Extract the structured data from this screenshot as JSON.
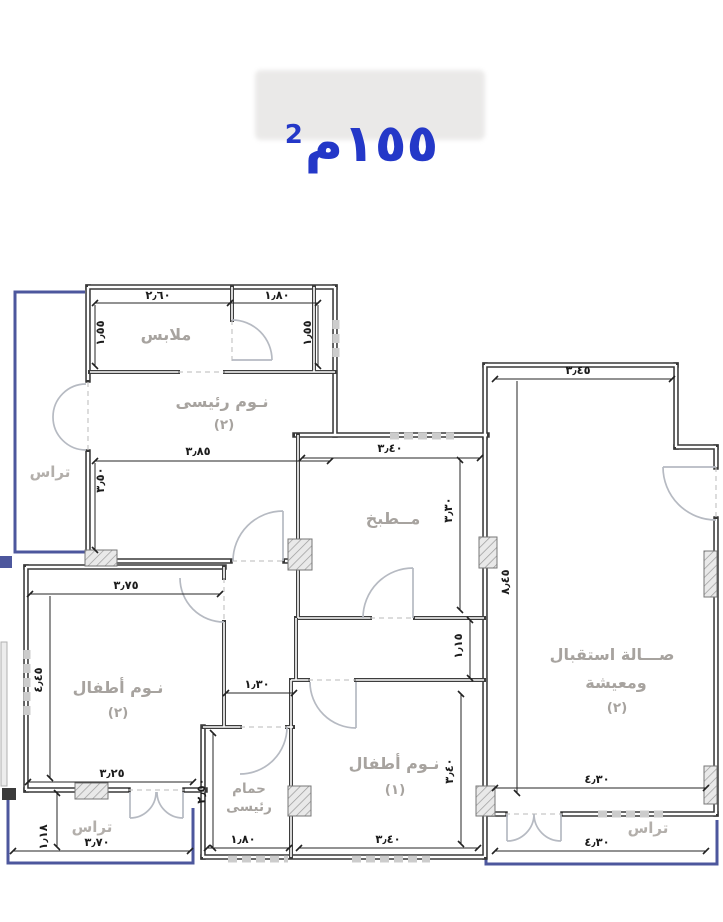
{
  "title": {
    "value": "١٥٥م",
    "sup": "2"
  },
  "colors": {
    "title_blue": "#2438c8",
    "terrace_outline": "#4d579d"
  },
  "rooms": {
    "closet": {
      "label": "ملابس"
    },
    "master_bedroom": {
      "line1": "نـوم رئيسى",
      "line2": "(٢)"
    },
    "terrace_left": {
      "label": "تراس"
    },
    "kitchen": {
      "label": "مــطبخ"
    },
    "reception": {
      "line1": "صـــالة استقبال",
      "line2": "ومعيشة",
      "line3": "(٢)"
    },
    "kids_bedroom_2": {
      "line1": "نـوم أطفال",
      "line2": "(٢)"
    },
    "master_bath": {
      "line1": "حمام",
      "line2": "رئيسى"
    },
    "kids_bedroom_1": {
      "line1": "نـوم أطفال",
      "line2": "(١)"
    },
    "terrace_bottom_left": {
      "label": "تراس"
    },
    "terrace_bottom_right": {
      "label": "تراس"
    }
  },
  "dimensions": {
    "closet_width": "٢٫٦٠",
    "dressing_width": "١٫٨٠",
    "closet_height": "١٫٥٥",
    "dressing_height": "١٫٥٥",
    "master_width": "٣٫٨٥",
    "master_height": "٣٫٥٠",
    "kitchen_width": "٣٫٤٠",
    "kitchen_height": "٣٫٣٠",
    "reception_width": "٣٫٤٥",
    "reception_height": "٨٫٤٥",
    "kids2_width_top": "٣٫٧٥",
    "kids2_height": "٤٫٤٥",
    "kids2_width_bottom": "٣٫٢٥",
    "bath_height": "٢٫٥٠",
    "hall_width": "١٫٣٠",
    "passage_height": "١٫١٥",
    "bath_width": "١٫٨٠",
    "kids1_width": "٣٫٤٠",
    "kids1_height": "٣٫٤٠",
    "reception_width_bottom": "٤٫٣٠",
    "terrace_right_width": "٤٫٣٠",
    "terrace_left_bottom_width": "٣٫٧٠",
    "terrace_left_bottom_height": "١٫١٨"
  }
}
